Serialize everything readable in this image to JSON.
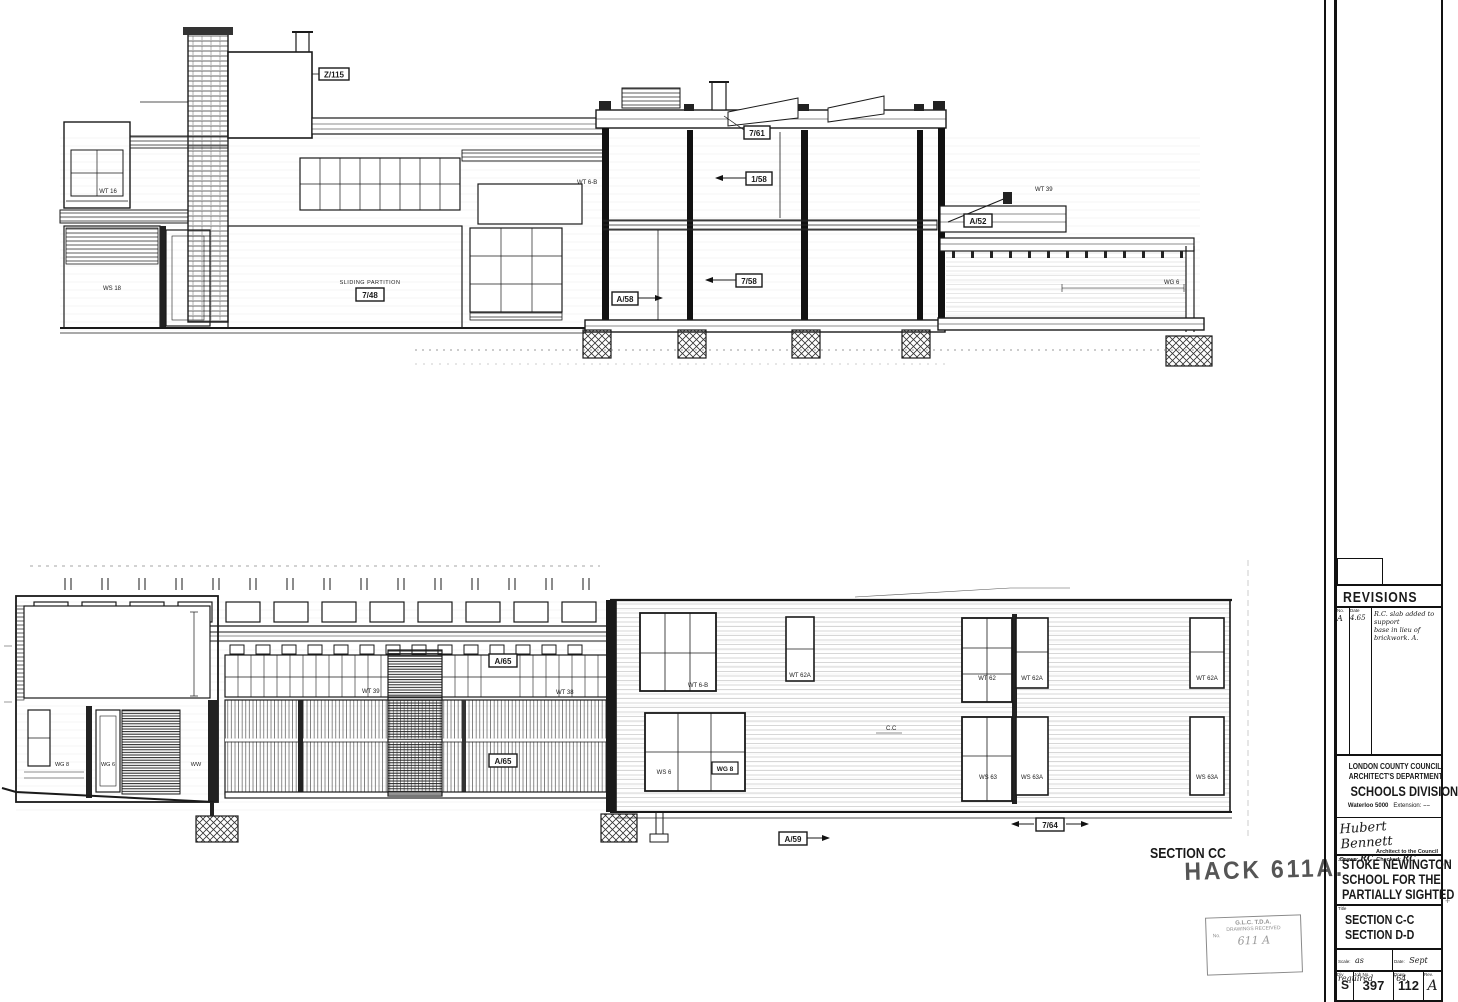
{
  "annotations": {
    "section_label": "SECTION CC",
    "hack_stamp": "HACK 611A.",
    "glc_stamp": {
      "line1": "G.L.C.  T.D.A.",
      "line2": "DRAWINGS RECEIVED",
      "line3": "No.",
      "scrawl": "611 A"
    }
  },
  "titleblock": {
    "revisions_title": "REVISIONS",
    "rev_col_no": "No.",
    "rev_col_date": "Date",
    "rev_no": "A",
    "rev_date": "4.65",
    "rev_note_line1": "R.C. slab added to support",
    "rev_note_line2": "base in lieu of brickwork. A.",
    "council_line1": "LONDON COUNTY COUNCIL",
    "council_line2": "ARCHITECT'S DEPARTMENT",
    "division": "SCHOOLS DIVISION",
    "phone": "Waterloo 5000",
    "extension_label": "Extension:",
    "extension_value": "––",
    "signature": "Hubert Bennett",
    "signature_title": "Architect to the Council",
    "drawn_label": "Drawn:",
    "drawn_value": "RC",
    "checked_label": "Checked:",
    "checked_value": "RC",
    "job_label": "Job",
    "job_line1": "STOKE NEWINGTON",
    "job_line2": "SCHOOL FOR THE",
    "job_line3": "PARTIALLY SIGHTED",
    "title_label": "Title",
    "title_line1": "SECTION  C-C",
    "title_line2": "SECTION  D-D",
    "scale_label": "Scale:",
    "scale_value": "as required",
    "date_label": "Date:",
    "date_value": "Sept '64.",
    "div_label": "Div",
    "div_value": "S",
    "jobno_label": "Job No.",
    "jobno_value": "397",
    "drwg_label": "Drwg.",
    "drwg_value": "112",
    "rev_label": "Rev.",
    "rev_value": "A"
  },
  "labels": {
    "z115": "Z/115",
    "d761": "7/61",
    "d158": "1/58",
    "d758": "7/58",
    "a58": "A/58",
    "d748": "7/48",
    "partition": "SLIDING PARTITION",
    "a52": "A/52",
    "wt16": "WT 16",
    "ws18": "WS 18",
    "wt6b_mid": "WT 6-B",
    "wt39_top": "WT 39",
    "wg6_top": "WG 6",
    "wt39": "WT 39",
    "wt38": "WT 38",
    "a65a": "A/65",
    "a65b": "A/65",
    "wg8_left": "WG 8",
    "wg6_left": "WG 6",
    "ww_left": "WW",
    "wt6b": "WT 6-B",
    "wt62a1": "WT 62A",
    "wt62": "WT 62",
    "wt62a2": "WT 62A",
    "wt62a3": "WT 62A",
    "ws6": "WS 6",
    "wg8_box": "WG 8",
    "ws63": "WS 63",
    "ws63a1": "WS 63A",
    "ws63a2": "WS 63A",
    "a59": "A/59",
    "d764": "7/64",
    "cc_mark": "C.C"
  }
}
